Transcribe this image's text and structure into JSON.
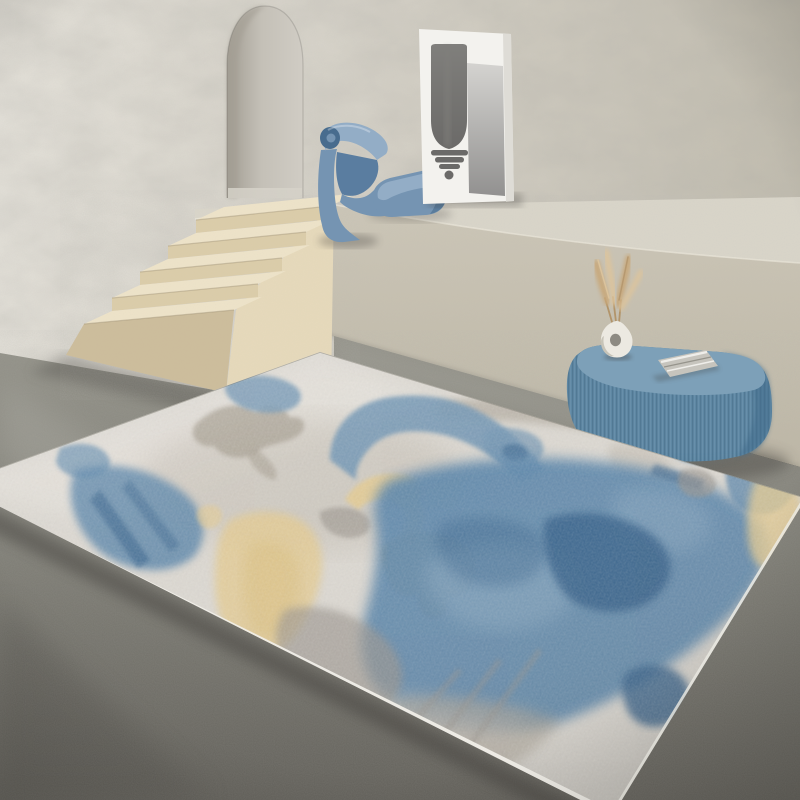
{
  "scene": {
    "description": "Product photo: abstract watercolour area rug (cream, steel blue, navy, gold, taupe) shown in a minimalist beige plaster room with arched niche, cream stone staircase, blue sculpted lounge chair, white art board with dark totem print, ribbed blue oval side table holding a white ring vase with dried pampas stems and a folded grey magazine, on a dark concrete floor",
    "objects": [
      "plaster back wall",
      "arched wall niche",
      "raised platform ledge",
      "cream staircase with five steps",
      "blue sculpted lounge chair",
      "white art board",
      "dark totem print",
      "grey gradient panel",
      "ribbed blue oval side table",
      "white ring vase",
      "dried pampas stems",
      "folded grey magazine",
      "dark concrete floor",
      "abstract area rug"
    ]
  },
  "palette": {
    "wall_light": "#e4e1d9",
    "wall_mid": "#d5d1c7",
    "wall_dark": "#c1bcae",
    "wall_vein": "#6e6b62",
    "arch_left": "#a29d93",
    "arch_mid": "#c4c0b7",
    "arch_right": "#d0ccc4",
    "arch_floor": "#d6d2c9",
    "platform_top": "#dad6ca",
    "platform_edge": "#eeeadd",
    "face_top": "#ccc6b7",
    "face_bottom": "#bdb6a4",
    "floor_light": "#939289",
    "floor_mid": "#807f77",
    "floor_dark": "#62605a",
    "floor_streak": "#b8b7af",
    "floor_shadow": "#4b4a44",
    "stair_tread": "#efe4c9",
    "stair_riser": "#dccda9",
    "stair_riser_dark": "#cdbd9b",
    "stair_side": "#e7dabb",
    "stair_nose": "#9a8b6d",
    "chair_blue": "#7594b2",
    "chair_light": "#93adc6",
    "chair_dark": "#5a7da0",
    "chair_deep": "#486c8e",
    "panel_white": "#f3f2ee",
    "panel_edge": "#d8d6d0",
    "panel_grad_top": "#d4d3d0",
    "panel_grad_bottom": "#929190",
    "sculpt_dark": "#6b6a68",
    "sculpt_light": "#807f7c",
    "table_blue": "#5e87a3",
    "table_light": "#7da0b8",
    "table_dark": "#3f6b8a",
    "table_rib": "#33566e",
    "vase_white": "#ece9e1",
    "vase_shade": "#b8b3a7",
    "vase_hole": "#8d8a82",
    "wheat": "#c8a87a",
    "wheat_light": "#ddc49c",
    "wheat_dark": "#b2946a",
    "magazine": "#c6c4bd",
    "magazine_light": "#efeeea",
    "magazine_dark": "#8a8880",
    "rug_base": "#dcd8d1",
    "rug_cream": "#e5e1da",
    "rug_cloud": "#c6c0b5",
    "rug_taupe": "#a49c8e",
    "rug_gray": "#98928a",
    "rug_blue": "#7195b3",
    "rug_blue_light": "#8dacc4",
    "rug_blue_mid": "#5c86aa",
    "rug_navy": "#2f5c87",
    "rug_gold": "#e5cb8f",
    "rug_gold_deep": "#d9bc76",
    "rug_olive": "#ab9150",
    "rug_binding": "#f0eee8",
    "rug_edge": "#807d74",
    "shadow_dark": "#3a3934"
  }
}
